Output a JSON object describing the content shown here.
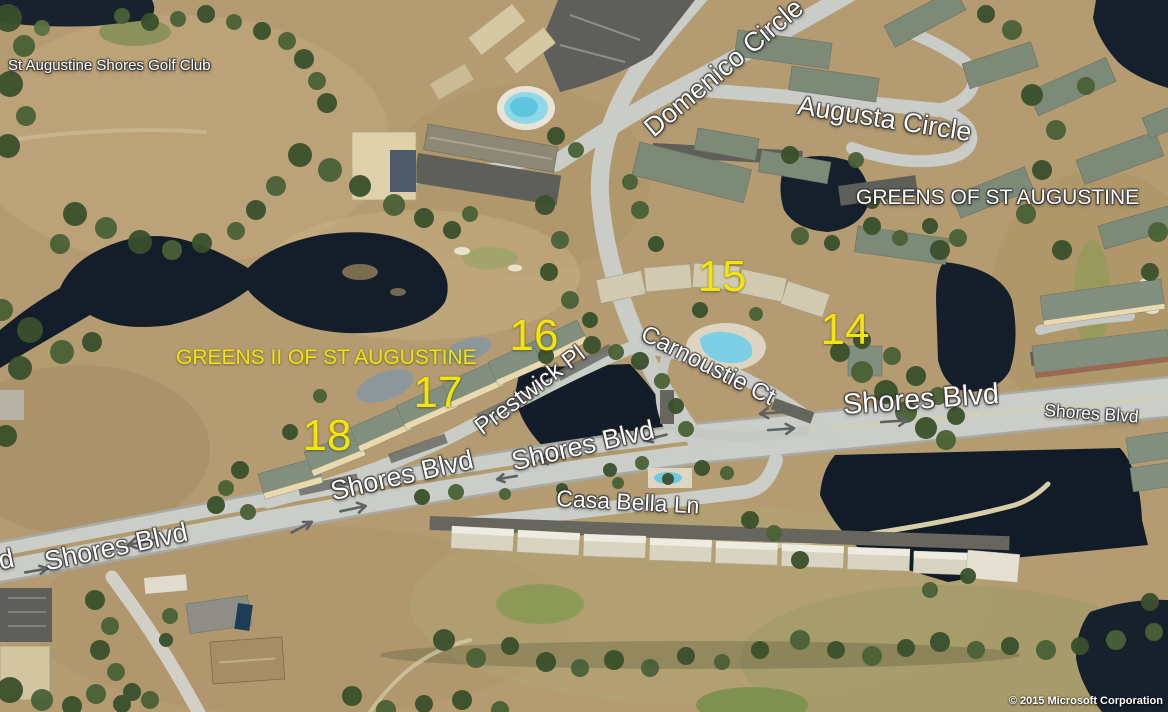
{
  "map": {
    "place_labels": {
      "golf_club": "St Augustine Shores Golf Club",
      "greens_1": "GREENS OF ST AUGUSTINE",
      "greens_2": "GREENS II OF ST AUGUSTINE"
    },
    "road_labels": {
      "domenico": "Domenico Circle",
      "augusta": "Augusta Circle",
      "prestwick": "Prestwick Pl",
      "carnoustie": "Carnoustie Ct",
      "casa_bella": "Casa Bella Ln",
      "shores_main": "Shores Blvd",
      "shores_right": "Shores Blvd",
      "shores_mid_east": "Shores Blvd",
      "shores_mid_west": "Shores Blvd",
      "shores_west": "Shores Blvd",
      "shores_partial": "d"
    },
    "hole_numbers": {
      "n14": "14",
      "n15": "15",
      "n16": "16",
      "n17": "17",
      "n18": "18"
    },
    "attribution": "© 2015 Microsoft Corporation",
    "icons": {
      "lane_arrow_left": "left-direction traffic arrow",
      "lane_arrow_right": "right-direction traffic arrow"
    },
    "colors": {
      "label_white": "#ffffff",
      "label_yellow": "#f1e50c",
      "water": "#141e2a",
      "road": "#cbcec8",
      "dry_grass": "#b49b72",
      "tree_green": "#3a502c",
      "pool_blue": "#7ccfe4"
    }
  }
}
